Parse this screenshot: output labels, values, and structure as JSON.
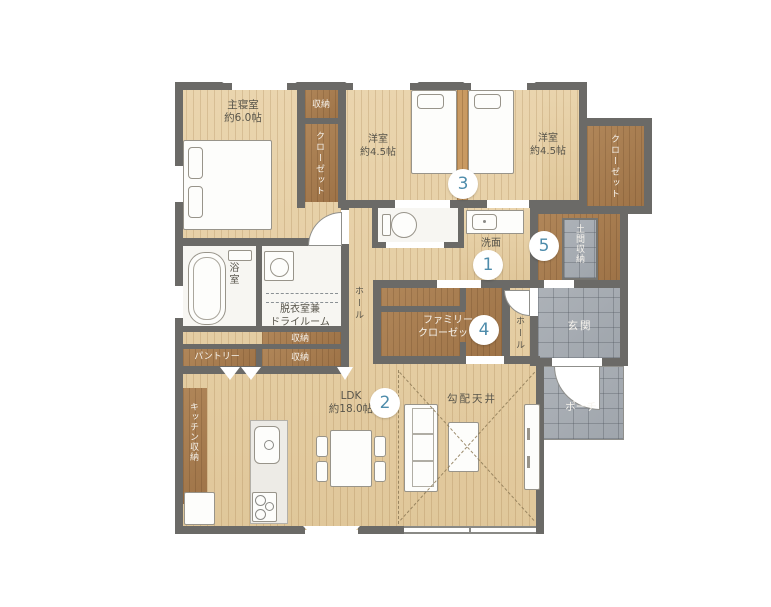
{
  "plan": {
    "type": "single-story-house-floor-plan",
    "rooms": {
      "master_bedroom": {
        "name": "主寝室",
        "size": "約6.0帖"
      },
      "storage_north": {
        "name": "収納"
      },
      "closet_west": {
        "name": "クローゼット"
      },
      "west_room_center": {
        "name": "洋室",
        "size": "約4.5帖"
      },
      "west_room_east": {
        "name": "洋室",
        "size": "約4.5帖"
      },
      "closet_east": {
        "name": "クローゼット"
      },
      "washroom": {
        "name": "洗面"
      },
      "bathroom": {
        "name": "浴室"
      },
      "dry_room": {
        "line1": "脱衣室兼",
        "line2": "ドライルーム"
      },
      "hall_center": {
        "name": "ホール"
      },
      "storage_mid_upper": {
        "name": "収納"
      },
      "pantry": {
        "name": "パントリー"
      },
      "storage_mid_lower": {
        "name": "収納"
      },
      "kitchen_storage": {
        "name": "キッチン収納"
      },
      "ldk": {
        "name": "LDK",
        "size": "約18.0帖"
      },
      "sloped_ceiling_note": {
        "name": "勾配天井"
      },
      "family_closet": {
        "line1": "ファミリー",
        "line2": "クローゼット"
      },
      "hall_entrance": {
        "name": "ホール"
      },
      "doma_storage": {
        "name": "土間収納"
      },
      "entrance": {
        "name": "玄関"
      },
      "porch": {
        "name": "ポーチ"
      }
    },
    "markers": {
      "m1": "1",
      "m2": "2",
      "m3": "3",
      "m4": "4",
      "m5": "5"
    },
    "colors": {
      "background_green": "#b7d393",
      "wall": "#6b6a67",
      "marker_number": "#4e8cab",
      "wood_floor": "#e7d1a8",
      "closet_brown": "#aa7f54",
      "tile_gray": "#a9aeb4"
    }
  }
}
